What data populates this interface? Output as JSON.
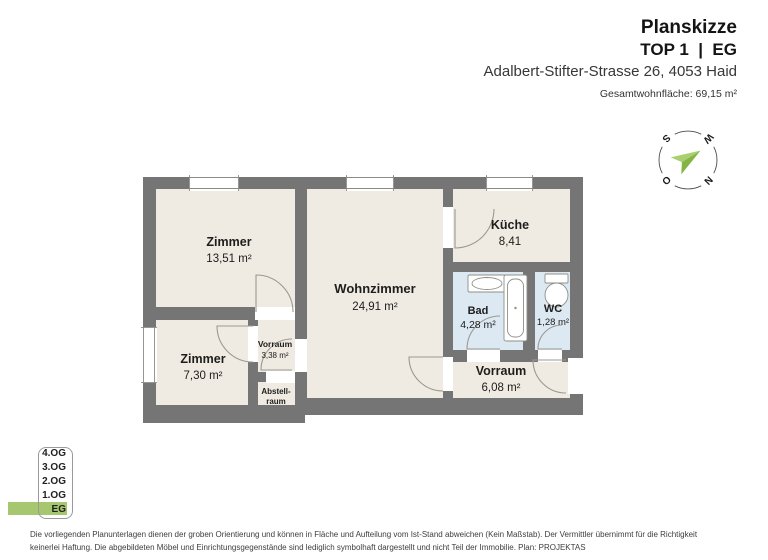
{
  "header": {
    "title": "Planskizze",
    "unit": "TOP 1  |  EG",
    "address": "Adalbert-Stifter-Strasse 26, 4053 Haid",
    "total_area": "Gesamtwohnfläche: 69,15 m²"
  },
  "compass": {
    "n": "N",
    "s": "S",
    "w": "W",
    "o": "O"
  },
  "rooms": {
    "zimmer1": {
      "name": "Zimmer",
      "area": "13,51 m²"
    },
    "wohnzimmer": {
      "name": "Wohnzimmer",
      "area": "24,91 m²"
    },
    "kueche": {
      "name": "Küche",
      "area": "8,41"
    },
    "bad": {
      "name": "Bad",
      "area": "4,28 m²"
    },
    "wc": {
      "name": "WC",
      "area": "1,28 m²"
    },
    "zimmer2": {
      "name": "Zimmer",
      "area": "7,30 m²"
    },
    "vorraum_klein": {
      "name": "Vorraum",
      "area": "3,38 m²"
    },
    "abstellraum": {
      "name_line1": "Abstell-",
      "name_line2": "raum"
    },
    "vorraum": {
      "name": "Vorraum",
      "area": "6,08 m²"
    }
  },
  "floor_selector": {
    "floors": [
      "4.OG",
      "3.OG",
      "2.OG",
      "1.OG",
      "EG"
    ],
    "active": "EG",
    "active_color": "#a6c76f"
  },
  "colors": {
    "wall": "#767575",
    "floor": "#f0ebe2",
    "wet_room": "#dce9f3",
    "needle_light": "#a9d06e",
    "needle_dark": "#84b544"
  },
  "disclaimer": {
    "line1": "Die vorliegenden Planunterlagen dienen der groben Orientierung und können in Fläche und Aufteilung vom Ist-Stand abweichen (Kein Maßstab). Der Vermittler übernimmt für die Richtigkeit",
    "line2": "keinerlei Haftung. Die abgebildeten Möbel und Einrichtungsgegenstände sind lediglich symbolhaft dargestellt und nicht Teil der Immobilie. Plan: PROJEKTAS"
  }
}
